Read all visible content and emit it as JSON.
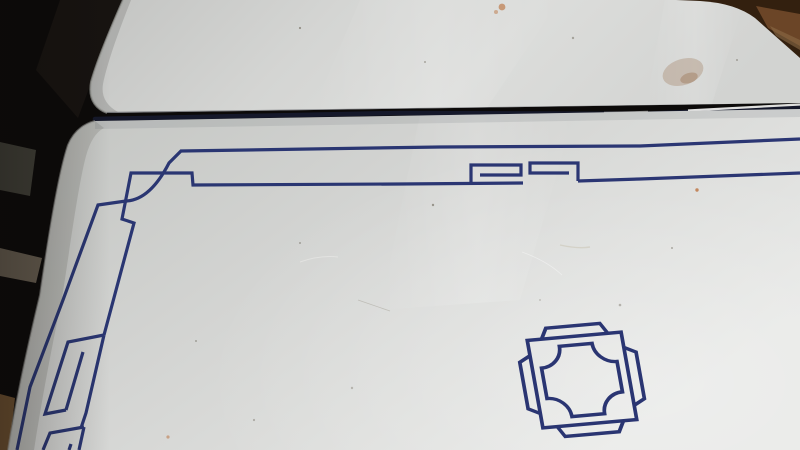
{
  "scene": {
    "title": "White enamel kitchen table top with cobalt blue line border, Greek-key corner ornament and octagonal center medallion, photographed at an angle over a dark floor",
    "objects": {
      "table_leaf": "raised white enamel leaf panel at top with rounded corners",
      "table_top": "main white enamel surface with blue painted decoration",
      "border": "double blue pin-stripe border with stepped corner and spiral key motifs",
      "medallion": "double-outlined square medallion with concave corners and side tabs",
      "background": "dark room floor, wooden furniture edge top-right, pale floor patches at left",
      "wear": "small rust spots, brown stains and specks on the enamel"
    }
  },
  "palette": {
    "bg-dark": "#0c0a09",
    "bg-dark2": "#171310",
    "bg-left-gray": "#45443c",
    "bg-left-light": "#6e6457",
    "bg-left-tan": "#7b5a36",
    "wood-dark": "#33200f",
    "wood-mid": "#6b4527",
    "leaf-dim": "#c7c8c6",
    "leaf-bright": "#e2e3e1",
    "main-dim": "#c6c8c5",
    "main-mid": "#d6d7d5",
    "main-bright": "#e9eae8",
    "edge-rim": "#9a9b97",
    "gap-dark": "#15182a",
    "highlight-white": "#f6f6f4",
    "line-blue": "#24306f",
    "line-blue-soft": "#31408a",
    "stain-brown": "#8a5a33",
    "rust-orange": "#b96a33",
    "speck": "#554e3e"
  }
}
